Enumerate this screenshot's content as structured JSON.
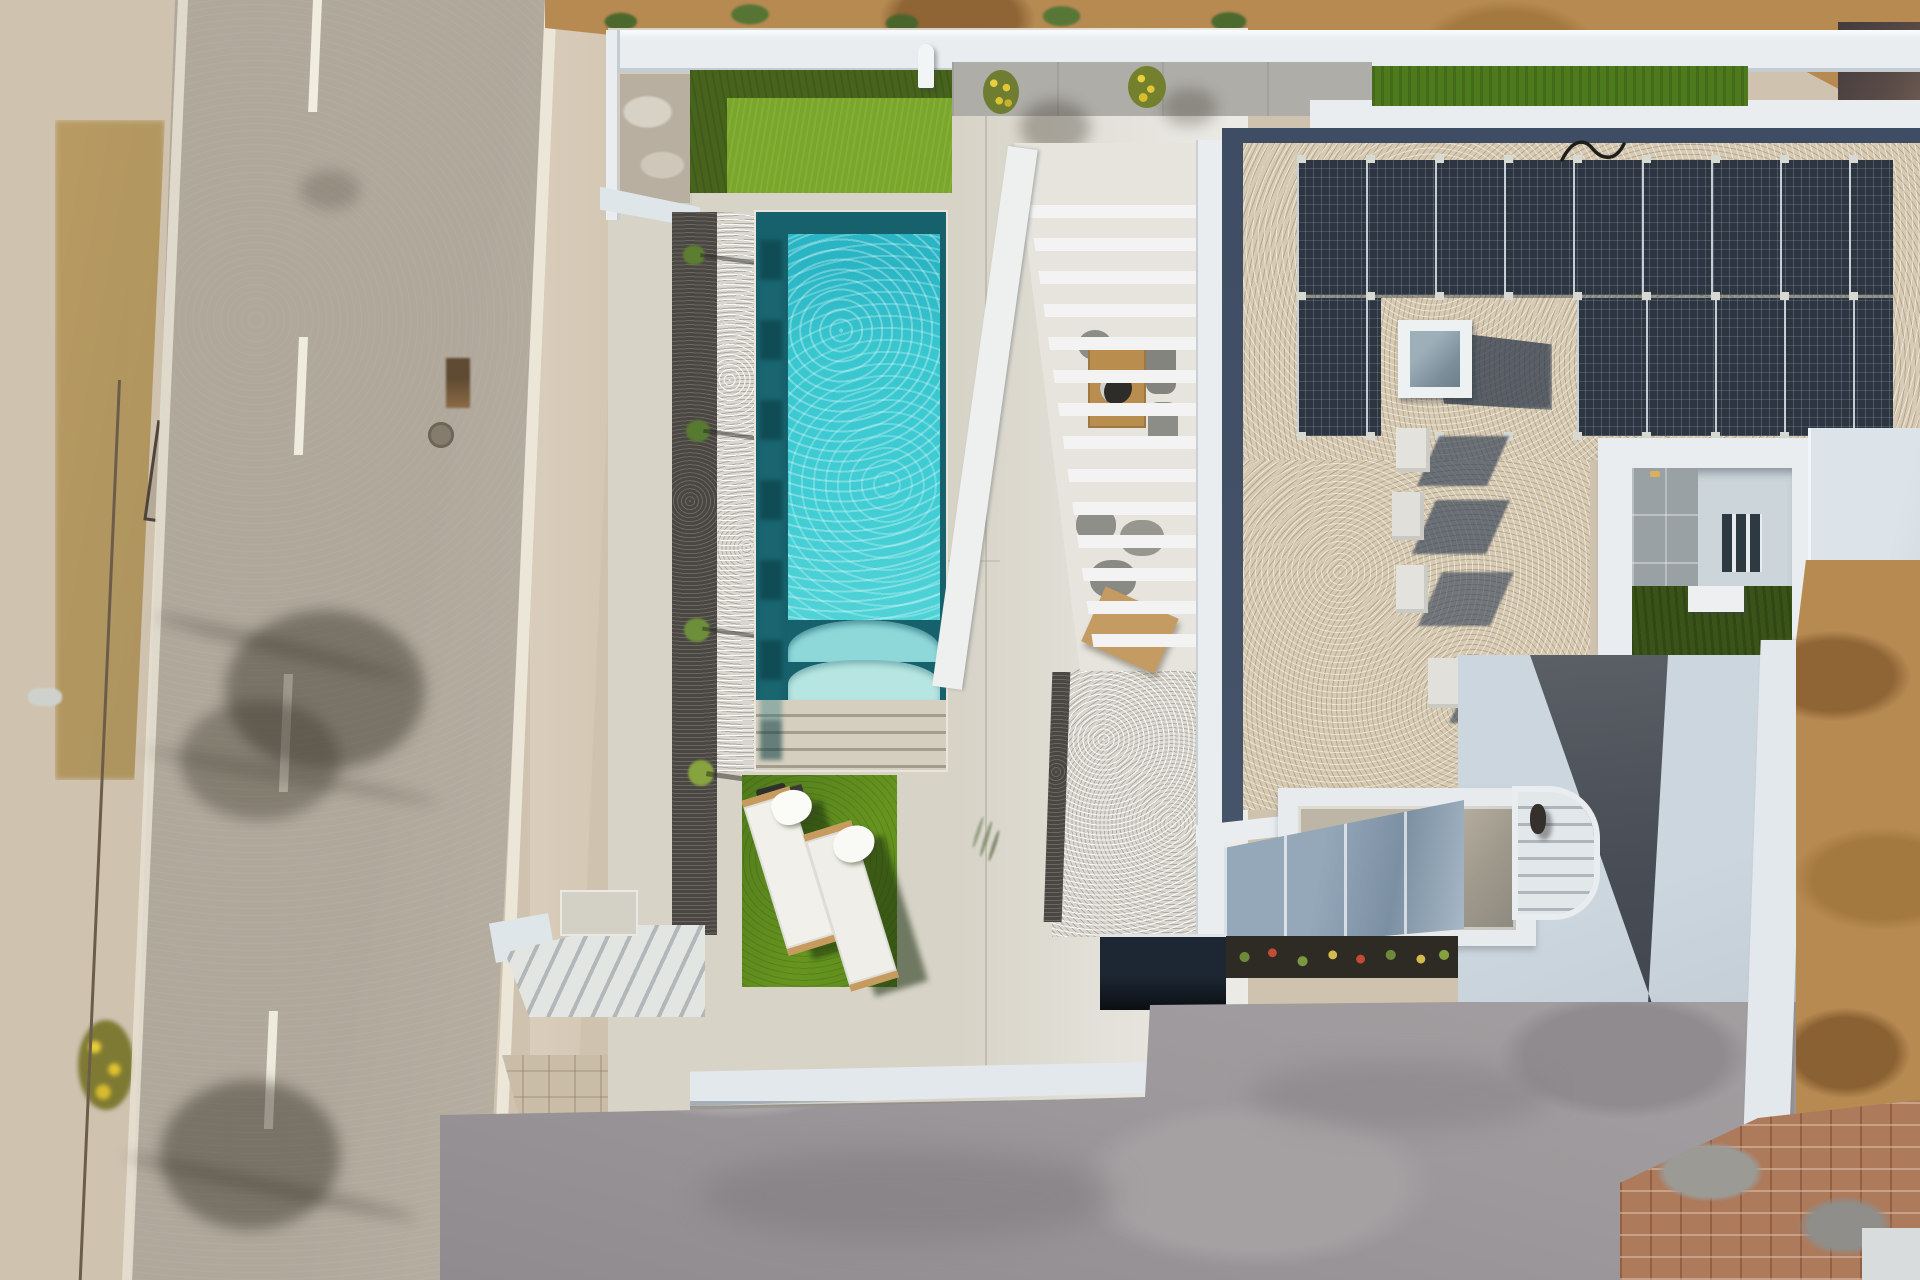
{
  "scene": {
    "type": "aerial-drone-photograph",
    "description": "Top-down drone photo of a modern white villa with a turquoise swimming pool, artificial grass patches, two sun loungers with white towels, a slatted pergola over an outdoor dining terrace, a gravel flat roof with a large photovoltaic solar array and skylight, a sunken courtyard patio, a curved staircase, an unfinished concrete driveway, and an asphalt road with scrubland on the left.",
    "time_of_day": "midday, strong sun, shadows falling to the south-east",
    "palette": {
      "road_asphalt": "#b0a89b",
      "road_markings": "#f0ece2",
      "sidewalk": "#d8ccba",
      "scrub_green": "#51702a",
      "scrub_dry": "#a98f4e",
      "villa_wall_white": "#e9edf0",
      "deck_paving": "#d7d3c7",
      "pool_water": "#38c6cf",
      "pool_edge_dark": "#17616c",
      "lawn_bright": "#7aa72a",
      "lawn_dark": "#47641d",
      "roof_gravel": "#d7cab2",
      "roof_border_gravel": "#3e4d63",
      "solar_panel": "#2c3540",
      "driveway_concrete": "#9b979a",
      "earth_dirt": "#b78a52",
      "brick_rubble": "#ad7a5c",
      "planter_soil": "#2e2a24",
      "pond_black": "#10151a"
    },
    "objects": [
      {
        "name": "scrubland-strip",
        "label": "dry scrub and bushes along road"
      },
      {
        "name": "road",
        "label": "two-lane asphalt road with dashed centre line"
      },
      {
        "name": "tree-shadow",
        "label": "tree shadows cast across road"
      },
      {
        "name": "sidewalk",
        "label": "beige sidewalk and paver strip"
      },
      {
        "name": "perimeter-wall",
        "label": "white blade perimeter wall"
      },
      {
        "name": "entry-pad",
        "label": "concrete entry pad"
      },
      {
        "name": "outdoor-shower",
        "label": "wall mounted outdoor shower"
      },
      {
        "name": "upper-lawn",
        "label": "two-tone artificial lawn at entrance"
      },
      {
        "name": "flower-pot",
        "label": "round pots with yellow flowers",
        "count": 2
      },
      {
        "name": "swimming-pool",
        "label": "rectangular turquoise pool with roman steps"
      },
      {
        "name": "pool-steps",
        "label": "wide access steps at pool end"
      },
      {
        "name": "gravel-planter",
        "label": "dark gravel planter bed with young plants"
      },
      {
        "name": "white-gravel-strip",
        "label": "white pebble drainage strip"
      },
      {
        "name": "lower-lawn",
        "label": "artificial lawn with sun loungers"
      },
      {
        "name": "sun-lounger",
        "label": "two white sun loungers with towels",
        "count": 2
      },
      {
        "name": "pergola",
        "label": "white slatted pergola over dining terrace"
      },
      {
        "name": "dining-set",
        "label": "wooden outdoor dining table and chairs"
      },
      {
        "name": "lounge-set",
        "label": "grey outdoor lounge chairs"
      },
      {
        "name": "pebble-wedge",
        "label": "white pebble bed beside terrace"
      },
      {
        "name": "flat-roof",
        "label": "gravel flat roof with dark drainage border"
      },
      {
        "name": "solar-array",
        "label": "photovoltaic panels in two rows"
      },
      {
        "name": "skylight",
        "label": "square roof skylight"
      },
      {
        "name": "ac-units",
        "label": "rooftop HVAC units with long shadows",
        "count": 5
      },
      {
        "name": "roof-cable",
        "label": "black cable on gravel"
      },
      {
        "name": "courtyard",
        "label": "sunken courtyard with tiles, lawn and glazing"
      },
      {
        "name": "walkway-path",
        "label": "dark grey walkway from courtyard"
      },
      {
        "name": "garage-roof",
        "label": "white carport roof with opening"
      },
      {
        "name": "curved-stairs",
        "label": "curved white exterior staircase"
      },
      {
        "name": "person",
        "label": "person on staircase landing"
      },
      {
        "name": "glass-facade",
        "label": "reflective glazed facade band"
      },
      {
        "name": "flower-planter",
        "label": "planter bed with small colourful plants"
      },
      {
        "name": "black-pond",
        "label": "black reflecting trough"
      },
      {
        "name": "driveway",
        "label": "unfinished grey concrete driveway"
      },
      {
        "name": "brick-rubble",
        "label": "terracotta brick paving / rubble corner"
      },
      {
        "name": "earthworks",
        "label": "excavated brown earth at plot edges"
      },
      {
        "name": "neighbour-panel",
        "label": "dark neighbouring roof corner"
      }
    ]
  }
}
